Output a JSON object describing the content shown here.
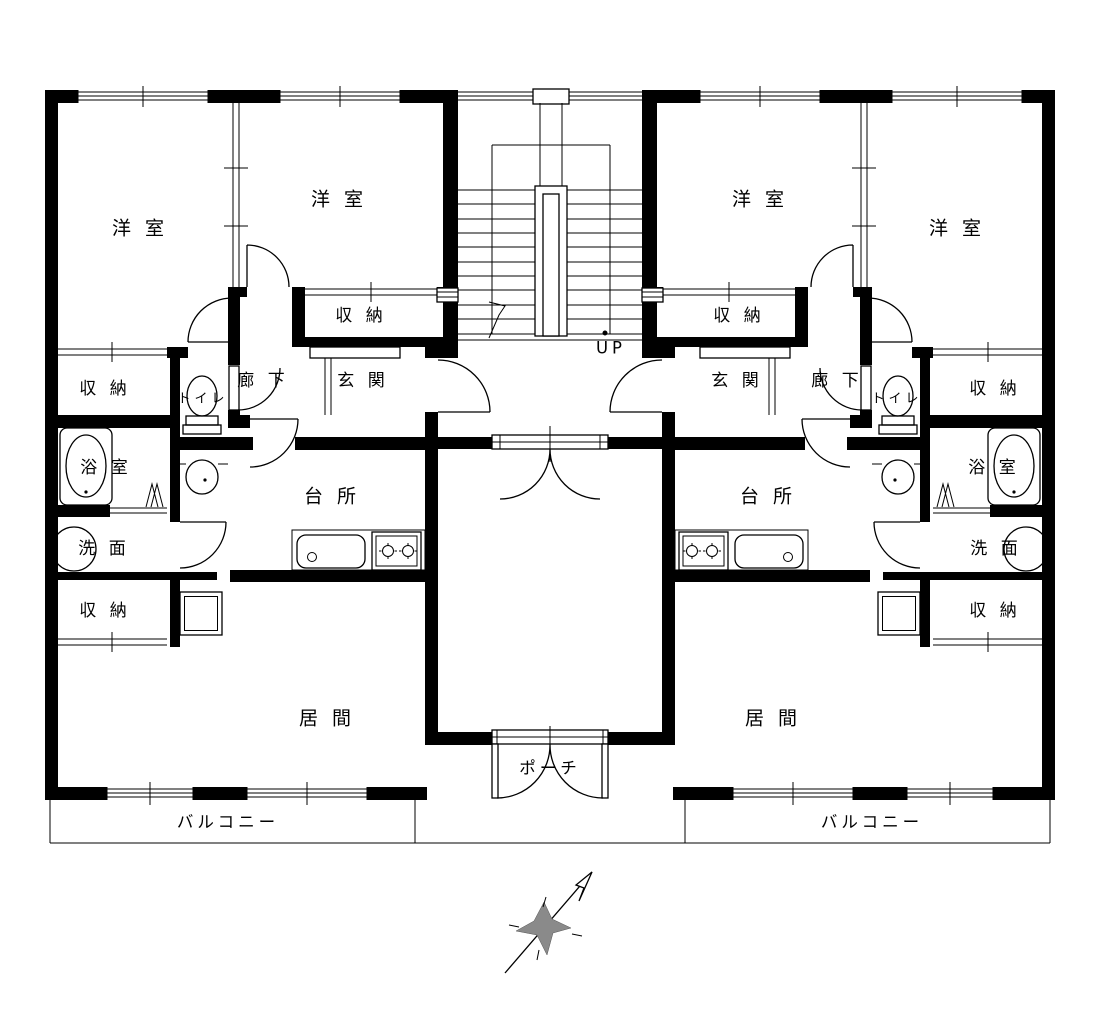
{
  "drawing": "apartment-floor-plan",
  "labels": {
    "bedroom": "洋 室",
    "storage": "収 納",
    "corridor": "廊 下",
    "entrance": "玄 関",
    "toilet": "トイレ",
    "bath": "浴 室",
    "washroom": "洗 面",
    "kitchen": "台 所",
    "living": "居 間",
    "balcony": "バルコニー",
    "porch": "ポーチ",
    "stairs_up": "UP"
  },
  "colors": {
    "line": "#000000",
    "background": "#ffffff",
    "compass_fill": "#8a8a8a"
  }
}
